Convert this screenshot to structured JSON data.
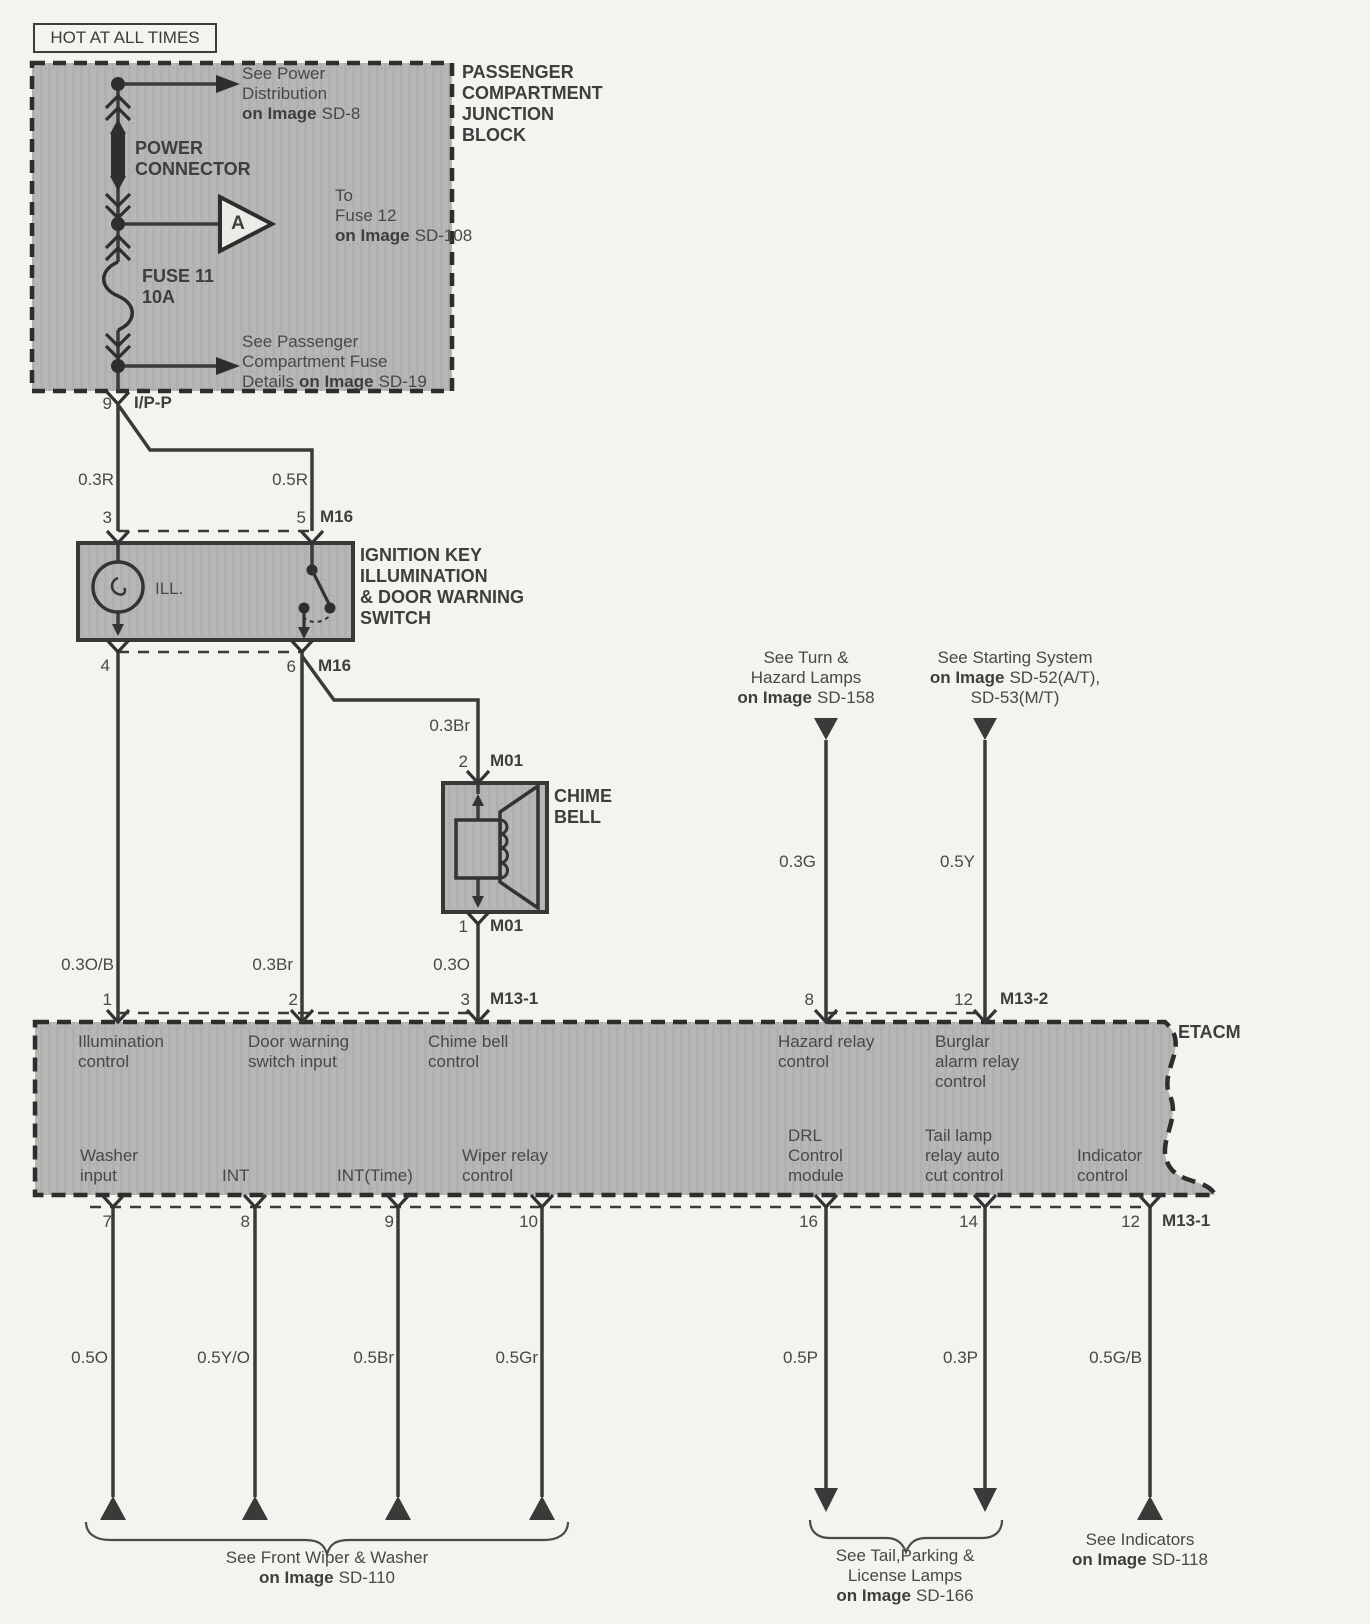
{
  "hot_tag": "HOT AT ALL TIMES",
  "junction_block": {
    "title_lines": [
      "PASSENGER",
      "COMPARTMENT",
      "JUNCTION",
      "BLOCK"
    ],
    "power_connector_lines": [
      "POWER",
      "CONNECTOR"
    ],
    "fuse_lines": [
      "FUSE 11",
      "10A"
    ],
    "triangle_letter": "A",
    "notes": {
      "power_distribution": {
        "l1": "See Power",
        "l2": "Distribution",
        "bold": "on Image",
        "ref": "SD-8"
      },
      "to_fuse12": {
        "l1": "To",
        "l2": "Fuse 12",
        "bold": "on Image",
        "ref": "SD-108"
      },
      "fuse_details": {
        "l1": "See Passenger",
        "l2": "Compartment Fuse",
        "pre": "Details",
        "bold": "on Image",
        "ref": "SD-19"
      }
    }
  },
  "ipp": {
    "pin": "9",
    "name": "I/P-P"
  },
  "upper_wires": {
    "left": "0.3R",
    "right": "0.5R"
  },
  "switch": {
    "top_pins": {
      "left": "3",
      "right": "5",
      "connector": "M16"
    },
    "bottom_pins": {
      "left": "4",
      "right": "6",
      "connector": "M16"
    },
    "lamp_label": "ILL.",
    "title_lines": [
      "IGNITION KEY",
      "ILLUMINATION",
      "& DOOR WARNING",
      "SWITCH"
    ]
  },
  "chime": {
    "branch_wire": "0.3Br",
    "top_pin": {
      "num": "2",
      "connector": "M01"
    },
    "bottom_pin": {
      "num": "1",
      "connector": "M01"
    },
    "title_lines": [
      "CHIME",
      "BELL"
    ]
  },
  "mid_wires": {
    "illumination": "0.3O/B",
    "door": "0.3Br",
    "chime": "0.3O",
    "hazard": "0.3G",
    "burglar": "0.5Y"
  },
  "offpage_top": {
    "turn": {
      "l1": "See Turn &",
      "l2": "Hazard Lamps",
      "bold": "on Image",
      "ref": "SD-158"
    },
    "starting": {
      "l1": "See Starting System",
      "bold": "on Image",
      "ref": "SD-52(A/T),",
      "l3": "SD-53(M/T)"
    }
  },
  "etacm": {
    "name": "ETACM",
    "top_pins": [
      {
        "num": "1",
        "label_lines": [
          "Illumination",
          "control"
        ]
      },
      {
        "num": "2",
        "label_lines": [
          "Door warning",
          "switch input"
        ]
      },
      {
        "num": "3",
        "connector": "M13-1",
        "label_lines": [
          "Chime bell",
          "control"
        ]
      },
      {
        "num": "8",
        "label_lines": [
          "Hazard relay",
          "control"
        ]
      },
      {
        "num": "12",
        "connector": "M13-2",
        "label_lines": [
          "Burglar",
          "alarm relay",
          "control"
        ]
      }
    ],
    "bottom_pins": [
      {
        "num": "7",
        "label_lines": [
          "Washer",
          "input"
        ],
        "wire": "0.5O"
      },
      {
        "num": "8",
        "label_lines": [
          "INT"
        ],
        "wire": "0.5Y/O"
      },
      {
        "num": "9",
        "label_lines": [
          "INT(Time)"
        ],
        "wire": "0.5Br"
      },
      {
        "num": "10",
        "label_lines": [
          "Wiper relay",
          "control"
        ],
        "wire": "0.5Gr"
      },
      {
        "num": "16",
        "label_lines": [
          "DRL",
          "Control",
          "module"
        ],
        "wire": "0.5P"
      },
      {
        "num": "14",
        "label_lines": [
          "Tail lamp",
          "relay auto",
          "cut control"
        ],
        "wire": "0.3P"
      },
      {
        "num": "12",
        "connector": "M13-1",
        "label_lines": [
          "Indicator",
          "control"
        ],
        "wire": "0.5G/B"
      }
    ]
  },
  "offpage_bottom": {
    "front_wiper": {
      "l1": "See Front Wiper & Washer",
      "bold": "on Image",
      "ref": "SD-110"
    },
    "tail": {
      "l1": "See Tail,Parking &",
      "l2": "License Lamps",
      "bold": "on Image",
      "ref": "SD-166"
    },
    "indicators": {
      "l1": "See Indicators",
      "bold": "on Image",
      "ref": "SD-118"
    }
  },
  "colors": {
    "box_gray": "#b6b6b4",
    "line": "#3a3a3a",
    "text": "#484848"
  }
}
